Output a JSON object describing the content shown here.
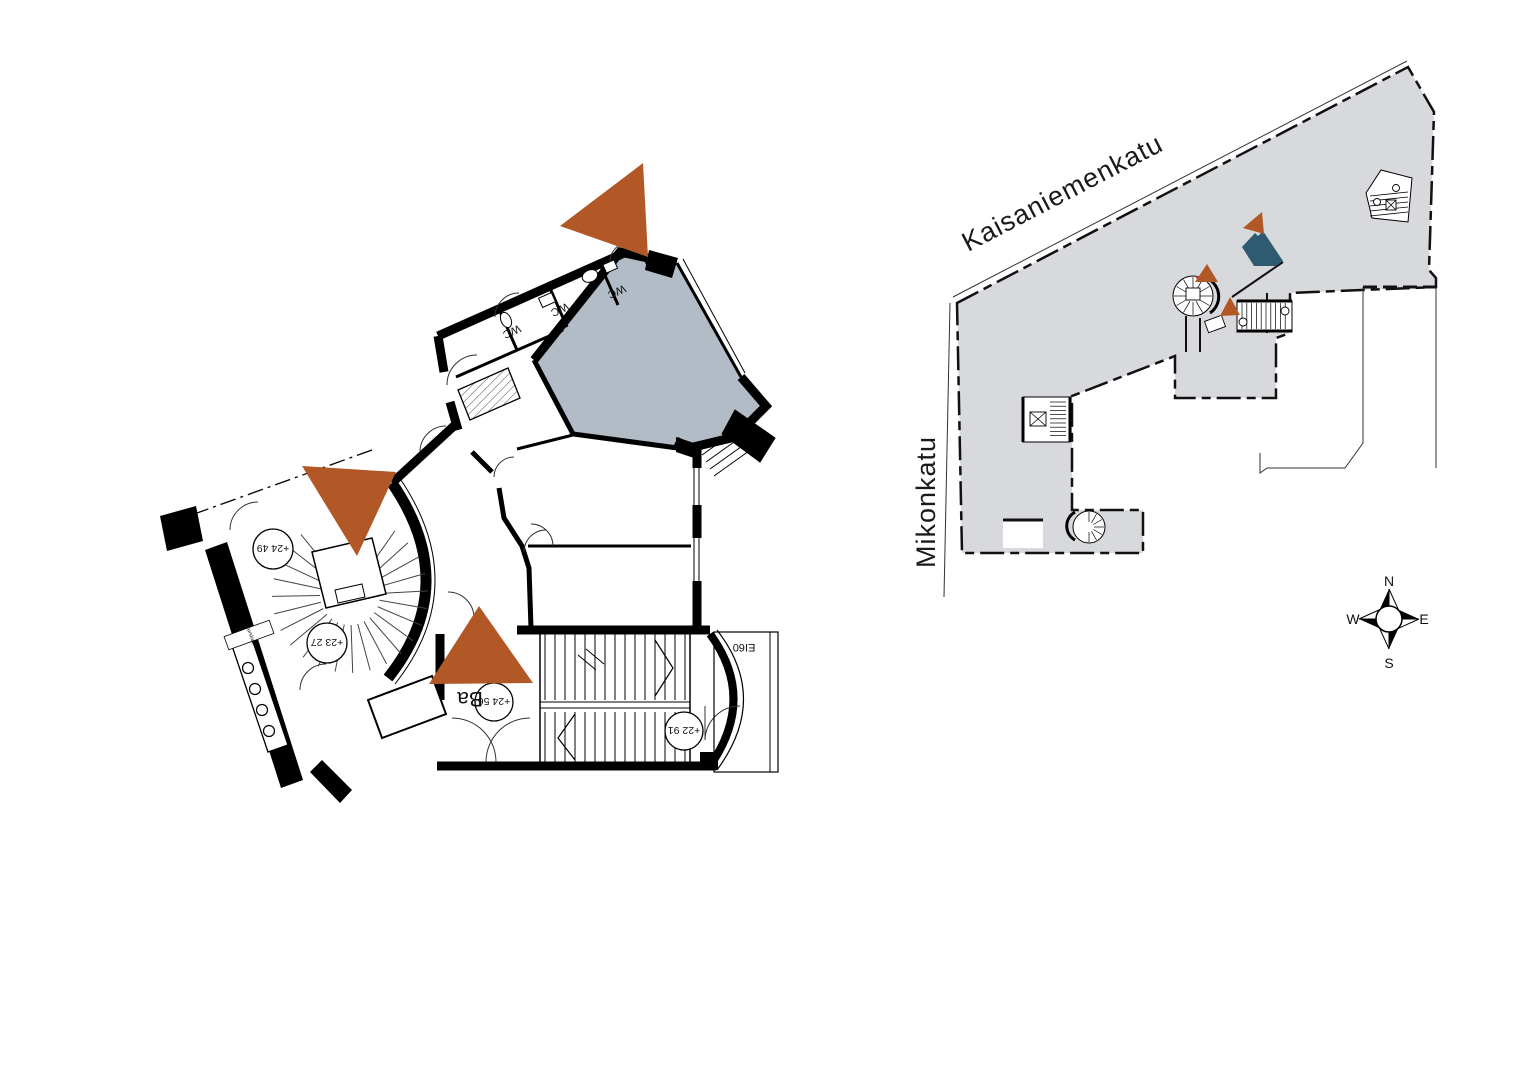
{
  "document": {
    "type": "architectural floor plan sheet",
    "background": "#ffffff"
  },
  "colors": {
    "marker_orange": "#B25827",
    "highlight_room_fill": "#B2BCC6",
    "site_building_fill": "#D8D9DD",
    "site_highlight_fill": "#2E5B70",
    "line_black": "#000000",
    "tiny_red_mark": "#A83A2F"
  },
  "floor_plan": {
    "wc_labels": [
      "WC",
      "WC",
      "WC"
    ],
    "labels": {
      "stair_name": "Ba",
      "fire_rating": "EI60",
      "small_note": "jäteputket"
    },
    "elevations": {
      "spiral_upper": "+24 49",
      "spiral_lower": "+23 27",
      "entrance": "+24 56",
      "stair_half_landing": "+22 91"
    },
    "markers": [
      {
        "name": "orange-triangle-marker-top"
      },
      {
        "name": "orange-triangle-marker-middle"
      },
      {
        "name": "orange-triangle-marker-bottom"
      }
    ]
  },
  "site_plan": {
    "streets": {
      "top": "Kaisaniemenkatu",
      "left": "Mikonkatu"
    },
    "compass": {
      "north": "N",
      "east": "E",
      "south": "S",
      "west": "W"
    },
    "markers": [
      {
        "name": "orange-triangle-marker-1"
      },
      {
        "name": "orange-triangle-marker-2"
      },
      {
        "name": "orange-triangle-marker-3"
      },
      {
        "name": "highlighted-unit-polygon"
      }
    ]
  }
}
